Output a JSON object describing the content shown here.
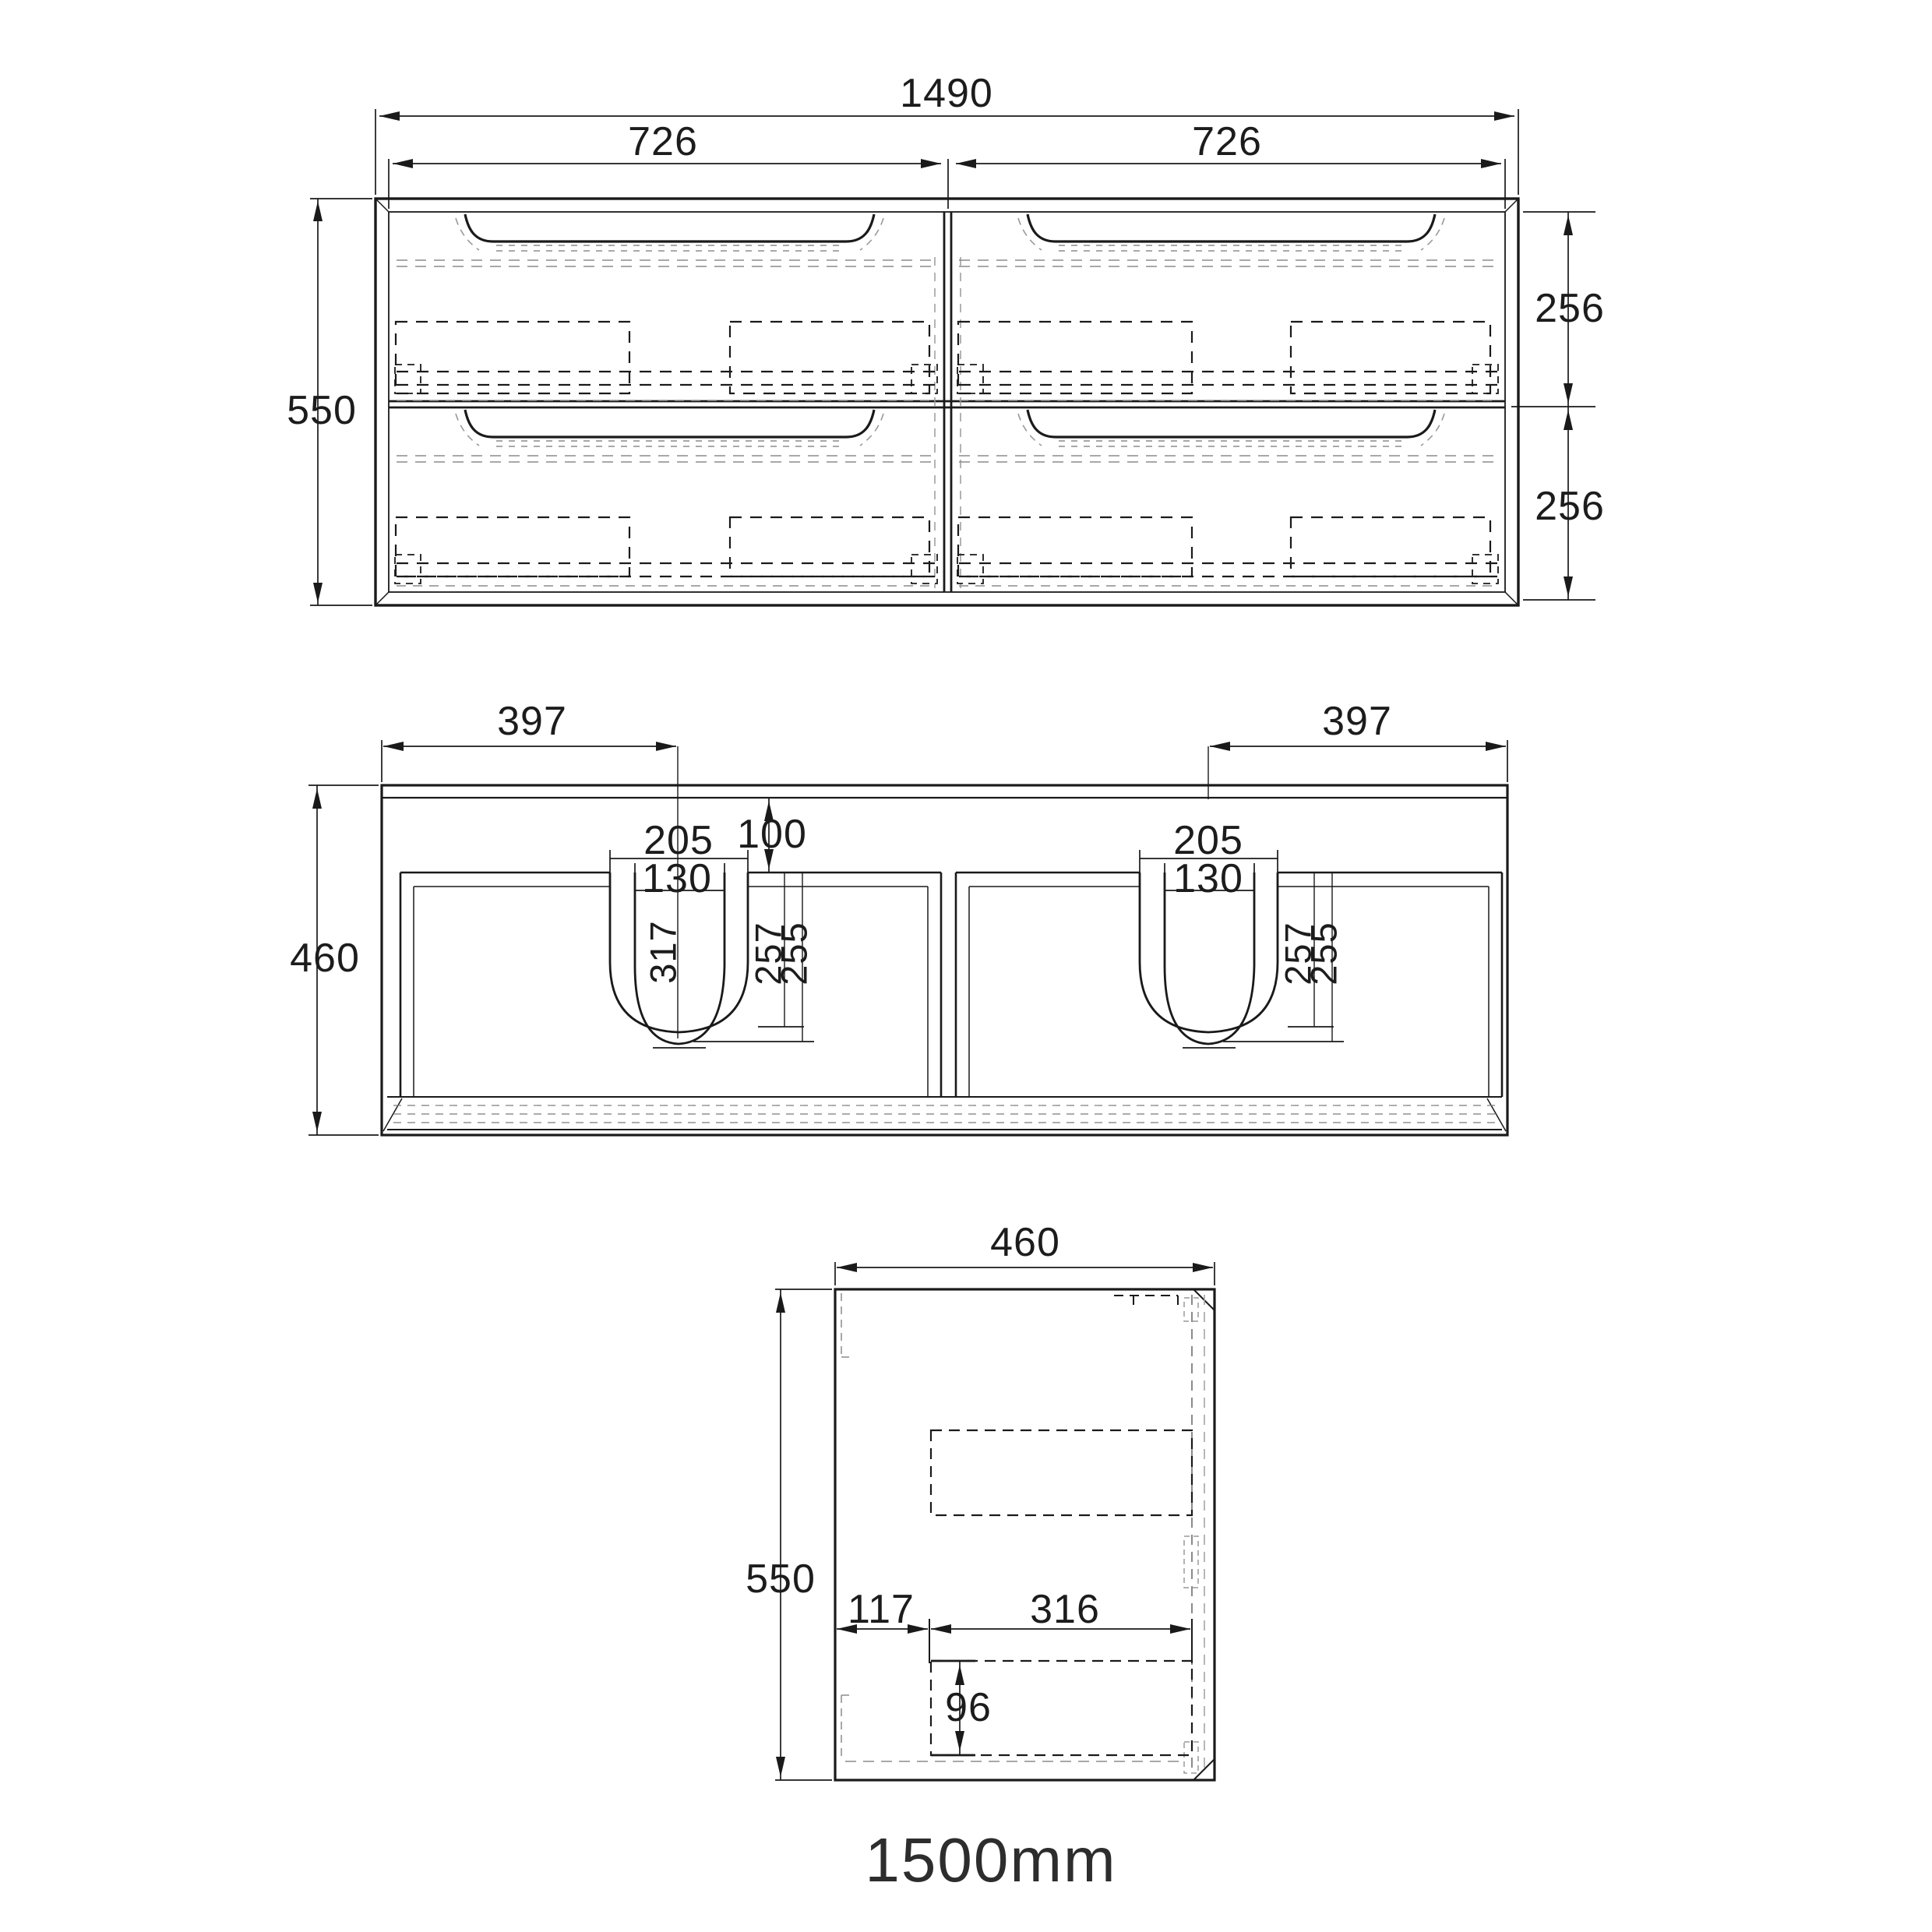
{
  "caption": "1500mm",
  "dims": {
    "front": {
      "overall_width": "1490",
      "left_half_width": "726",
      "right_half_width": "726",
      "height": "550",
      "top_drawer_height": "256",
      "bottom_drawer_height": "256"
    },
    "section": {
      "left_basin_offset": "397",
      "right_basin_offset": "397",
      "height": "460",
      "left_basin": {
        "rim_width": "205",
        "cutout_width": "130",
        "top_gap": "100",
        "bowl_depth": "317",
        "outer_depth": "257",
        "inner_depth": "255"
      },
      "right_basin": {
        "rim_width": "205",
        "cutout_width": "130",
        "outer_depth": "257",
        "inner_depth": "255"
      }
    },
    "side": {
      "depth": "460",
      "height": "550",
      "front_offset": "117",
      "recess_width": "316",
      "recess_height": "96"
    }
  },
  "colors": {
    "line": "#1a1a1a",
    "grey_dash": "#8c8c8c",
    "background": "#ffffff"
  }
}
